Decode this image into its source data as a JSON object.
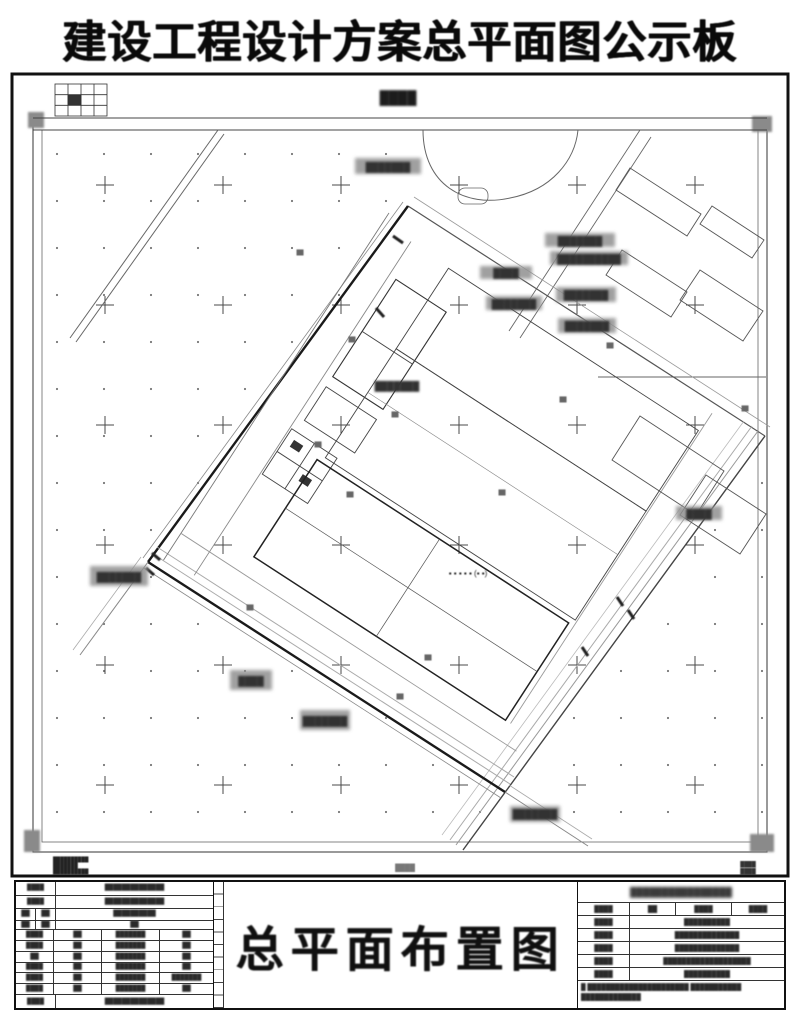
{
  "page": {
    "title": "建设工程设计方案总平面图公示板"
  },
  "titleblock": {
    "drawing_title": "总平面布置图"
  },
  "drawing": {
    "dots_row": "▪ ▪ ▪ ▪ ▪ (▪ ▪)",
    "scale_note": "████"
  },
  "redacted": {
    "xs": "██",
    "s": "████",
    "m": "███████",
    "l": "██████████",
    "xl": "██████████████",
    "xxl": "███████████████████",
    "header": "████████████████",
    "note_l1": "█ ██████████████████████ ███████████",
    "note_l2": "█████████████"
  },
  "colors": {
    "ink": "#111111",
    "gray_line": "#888888",
    "label_box": "#909090"
  }
}
